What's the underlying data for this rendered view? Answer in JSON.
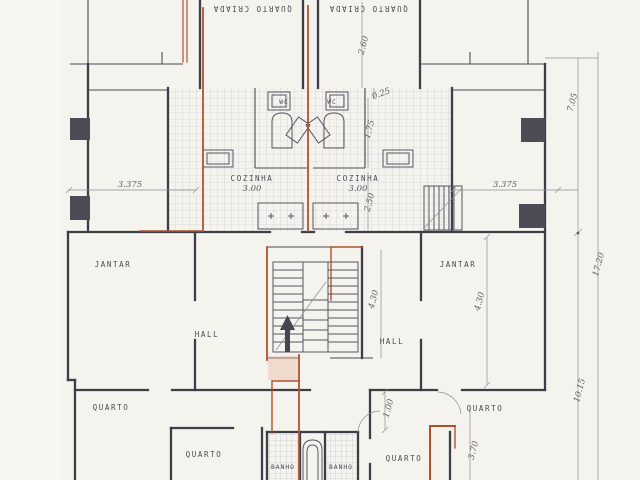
{
  "document": {
    "type": "architectural-floor-plan",
    "style": "scanned blueprint, two mirrored apartment units with red pencil annotations"
  },
  "rooms": {
    "maid_left": "QUARTO CRIADA",
    "maid_right": "QUARTO CRIADA",
    "wc_left": "WC",
    "wc_right": "WC",
    "kitchen_left": "COZINHA",
    "kitchen_right": "COZINHA",
    "dining_left": "JANTAR",
    "dining_right": "JANTAR",
    "hall_left": "HALL",
    "hall_right": "HALL",
    "bedroom_left": "QUARTO",
    "bedroom_left_inner": "QUARTO",
    "bedroom_center": "QUARTO",
    "bedroom_right": "QUARTO",
    "bath_left": "BANHO",
    "bath_right": "BANHO"
  },
  "dimensions": {
    "kitchen_left_width": "3.00",
    "kitchen_right_width": "3.00",
    "bay_left": "3.375",
    "bay_right": "3.375",
    "maid_depth": "2.60",
    "wall_offset": "0.25",
    "bath_depth": "1.75",
    "kitchen_depth": "2.50",
    "stair_length": "4.30",
    "dining_length": "4.30",
    "corridor_width": "1.00",
    "bedroom_length": "3.70",
    "right_upper_total": "7.05",
    "right_lower_total": "10.15",
    "right_overall": "17.20"
  },
  "colors": {
    "paper": "#f5f3ee",
    "ink": "#3e3e49",
    "annotation_red": "#b0512d",
    "tile_grid": "#c6c5cd"
  },
  "icons": {
    "stair_direction": "up-arrow"
  }
}
